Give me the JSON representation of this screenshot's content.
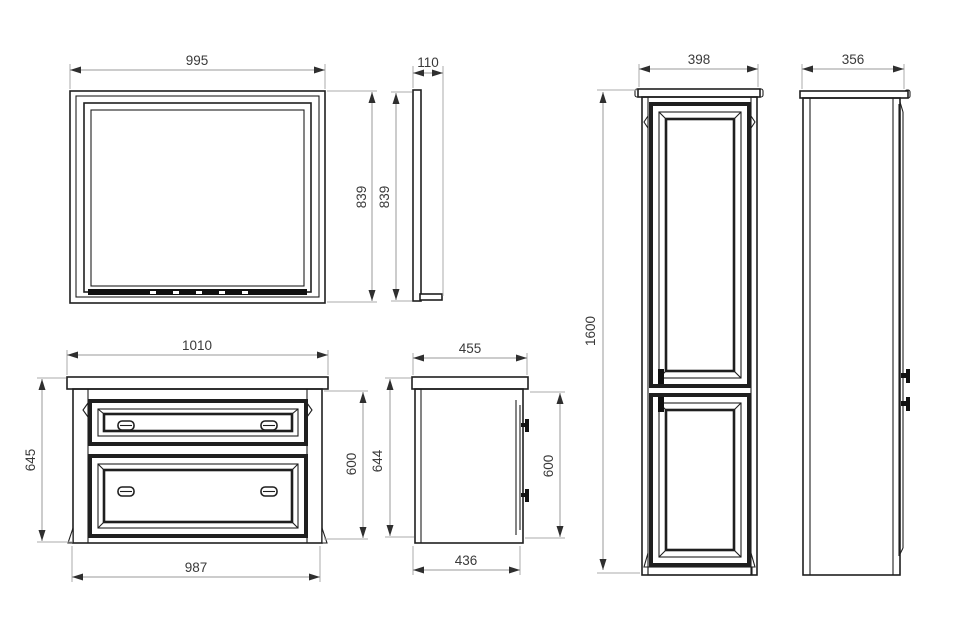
{
  "drawing": {
    "dimensions": {
      "mirror_front": {
        "width": "995",
        "height": "839"
      },
      "mirror_side": {
        "depth": "110",
        "height": "839"
      },
      "vanity_front": {
        "top_width": "1010",
        "overall_height": "645",
        "body_height": "600",
        "body_width": "987"
      },
      "vanity_side": {
        "top_depth": "455",
        "overall_height": "644",
        "body_height": "600",
        "body_depth": "436"
      },
      "tall_cabinet_front": {
        "width": "398",
        "height": "1600"
      },
      "tall_cabinet_side": {
        "depth": "356"
      }
    },
    "colors": {
      "object_line": "#1f1f1f",
      "dimension_line": "#9a9a9a",
      "label_text": "#3a3a3a",
      "background": "#ffffff"
    }
  }
}
